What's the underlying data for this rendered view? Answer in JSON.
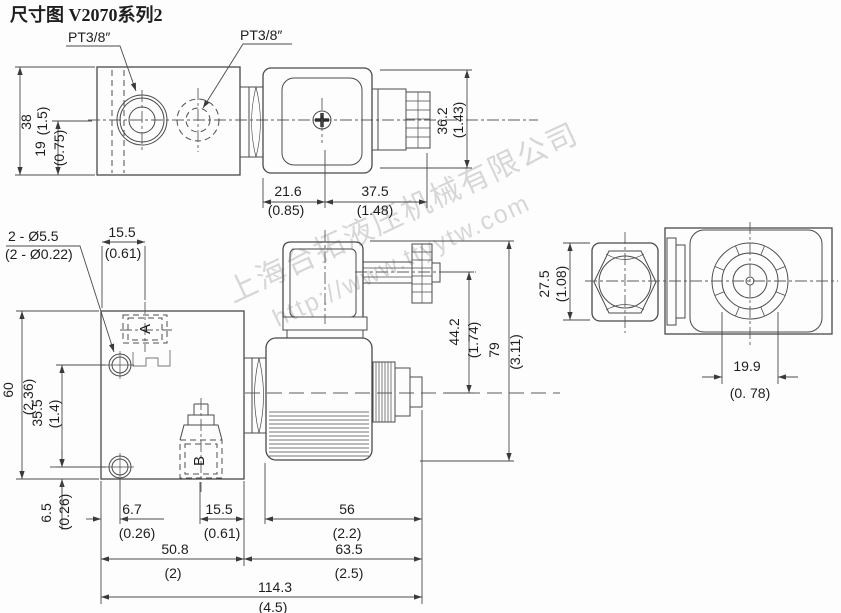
{
  "title": "尺寸图 V2070系列2",
  "watermark": {
    "company": "上海台拓液压机械有限公司",
    "url": "http://www.ttyytw.com"
  },
  "labels": {
    "port1": "PT3/8″",
    "port2": "PT3/8″",
    "port_a": "A",
    "port_b": "B",
    "holes_mm": "2 - Ø5.5",
    "holes_in": "(2 - Ø0.22)"
  },
  "dims": {
    "v38": {
      "mm": "38",
      "in": "(1.5)"
    },
    "v19": {
      "mm": "19",
      "in": "(0.75)"
    },
    "v36_2": {
      "mm": "36.2",
      "in": "(1.43)"
    },
    "v21_6": {
      "mm": "21.6",
      "in": "(0.85)"
    },
    "v37_5": {
      "mm": "37.5",
      "in": "(1.48)"
    },
    "t15_5": {
      "mm": "15.5",
      "in": "(0.61)"
    },
    "v60": {
      "mm": "60",
      "in": "(2.36)"
    },
    "v35_5": {
      "mm": "35.5",
      "in": "(1.4)"
    },
    "v6_5": {
      "mm": "6.5",
      "in": "(0.26)"
    },
    "b6_7": {
      "mm": "6.7",
      "in": "(0.26)"
    },
    "b15_5": {
      "mm": "15.5",
      "in": "(0.61)"
    },
    "b56": {
      "mm": "56",
      "in": "(2.2)"
    },
    "b50_8": {
      "mm": "50.8",
      "in": "(2)"
    },
    "b63_5": {
      "mm": "63.5",
      "in": "(2.5)"
    },
    "b114_3": {
      "mm": "114.3",
      "in": "(4.5)"
    },
    "v44_2": {
      "mm": "44.2",
      "in": "(1.74)"
    },
    "v79": {
      "mm": "79",
      "in": "(3.11)"
    },
    "v27_5": {
      "mm": "27.5",
      "in": "(1.08)"
    },
    "b19_9": {
      "mm": "19.9",
      "in": "(0. 78)"
    }
  }
}
